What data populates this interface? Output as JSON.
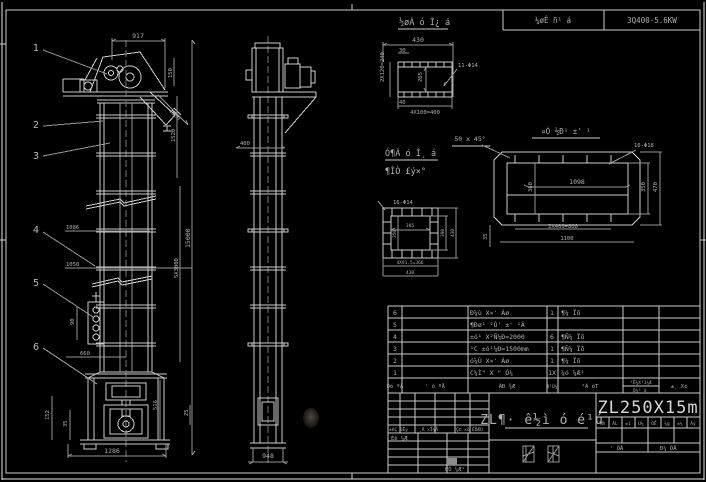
{
  "header_bar": {
    "left_cell": "¼øÊ ñ¹ á",
    "right_cell": "3Q400-5.6KW"
  },
  "front_view": {
    "callout_1": "1",
    "callout_2": "2",
    "callout_3": "3",
    "callout_4": "4",
    "callout_5": "5",
    "callout_6": "6",
    "dim_width_top": "917",
    "dim_150": "150",
    "dim_1500": "1500",
    "dim_1520": "1520",
    "dim_15000": "15000",
    "dim_5x3000": "5X3000",
    "dim_1086": "1086",
    "dim_1050": "1050",
    "dim_90": "90",
    "dim_660": "660",
    "dim_152": "152",
    "dim_35": "35",
    "dim_1286": "1286",
    "dim_516": "516",
    "dim_25": "25"
  },
  "side_view": {
    "dim_400": "400",
    "dim_948": "948"
  },
  "detail_flange": {
    "title": "½øÁ ó Ì¿ á",
    "dim_430": "430",
    "dim_30": "30",
    "dim_240": "2X120=240",
    "dim_265": "265",
    "dim_40": "40",
    "dim_400": "4X100=400",
    "holes": "11-Φ14"
  },
  "notes": {
    "chamfer": "50 x 45°",
    "line1": "Ó¶Á ó Ì¸ á",
    "line2": "¶ÌÒ £ý×°"
  },
  "detail_inlet": {
    "title": "¤Ó ½Ð¹ ±' ¹",
    "holes": "10-Φ18",
    "dim_1098": "1098",
    "dim_360": "360",
    "dim_350": "350",
    "dim_470": "470",
    "dim_800": "2X400=800",
    "dim_1100": "1100",
    "dim_35": "35"
  },
  "detail_plate": {
    "holes": "16-Φ14",
    "dim_305": "305",
    "dim_350": "350",
    "dim_390": "390",
    "dim_430": "430",
    "dim_366": "4X91.5=366",
    "dim_430b": "430"
  },
  "parts_table": {
    "rows": [
      {
        "no": "6",
        "name": "Ð¼ù X×' Áø",
        "qty": "1",
        "material": "¶¼ Ïõ"
      },
      {
        "no": "5",
        "name": "¶Ðø¹ ²Ó' ±' ¹Á",
        "qty": "",
        "material": ""
      },
      {
        "no": "4",
        "name": "±ó¹ X²Ñ¼Ð=2000",
        "qty": "6",
        "material": "¶Ñ¼ Ïõ"
      },
      {
        "no": "3",
        "name": "¹C ±ó¹¼Ð=1500mm",
        "qty": "1",
        "material": "¶Ñ¼ Ïõ"
      },
      {
        "no": "2",
        "name": "ó¼Ù X×' Áø",
        "qty": "1",
        "material": "¶¼ Ïõ"
      },
      {
        "no": "1",
        "name": "C¼Ì\" X \" Ó¾",
        "qty": "1X",
        "material": "¼ó ¼Æ¹"
      }
    ],
    "header": {
      "no": "Ðó ºÅ",
      "code": "' ó ºÅ",
      "name": "ÃÐ ¾Æ",
      "qty": "¶¹Ù¼",
      "material": "²Á óT",
      "weight_top": "¹Ê¼X¹1¼Æ",
      "weight_bottom": "Ó¾¹ ò¸",
      "remark": "±¸ X¢"
    }
  },
  "title_block": {
    "product_name": "ZL¶· ê½ì ó é¹ú",
    "model": "ZL250X15m",
    "rev_cells": [
      "±êÇ ÐÊý",
      "¸Ä ×Î¼Å",
      "Ç© ×ö",
      "ÈÕÆÚ"
    ],
    "design_label": "Éè ¼Æ",
    "check_label": "ÉÓ ¼Æ¹",
    "stage_cells": [
      "¶Ñ",
      "ÁL",
      "±1",
      "Ù¼",
      "ÓÊ",
      "¼g",
      "±¼",
      "Àý"
    ],
    "sheet_left": "' ÕÅ",
    "sheet_right": "Ð¼ ÕÅ"
  }
}
